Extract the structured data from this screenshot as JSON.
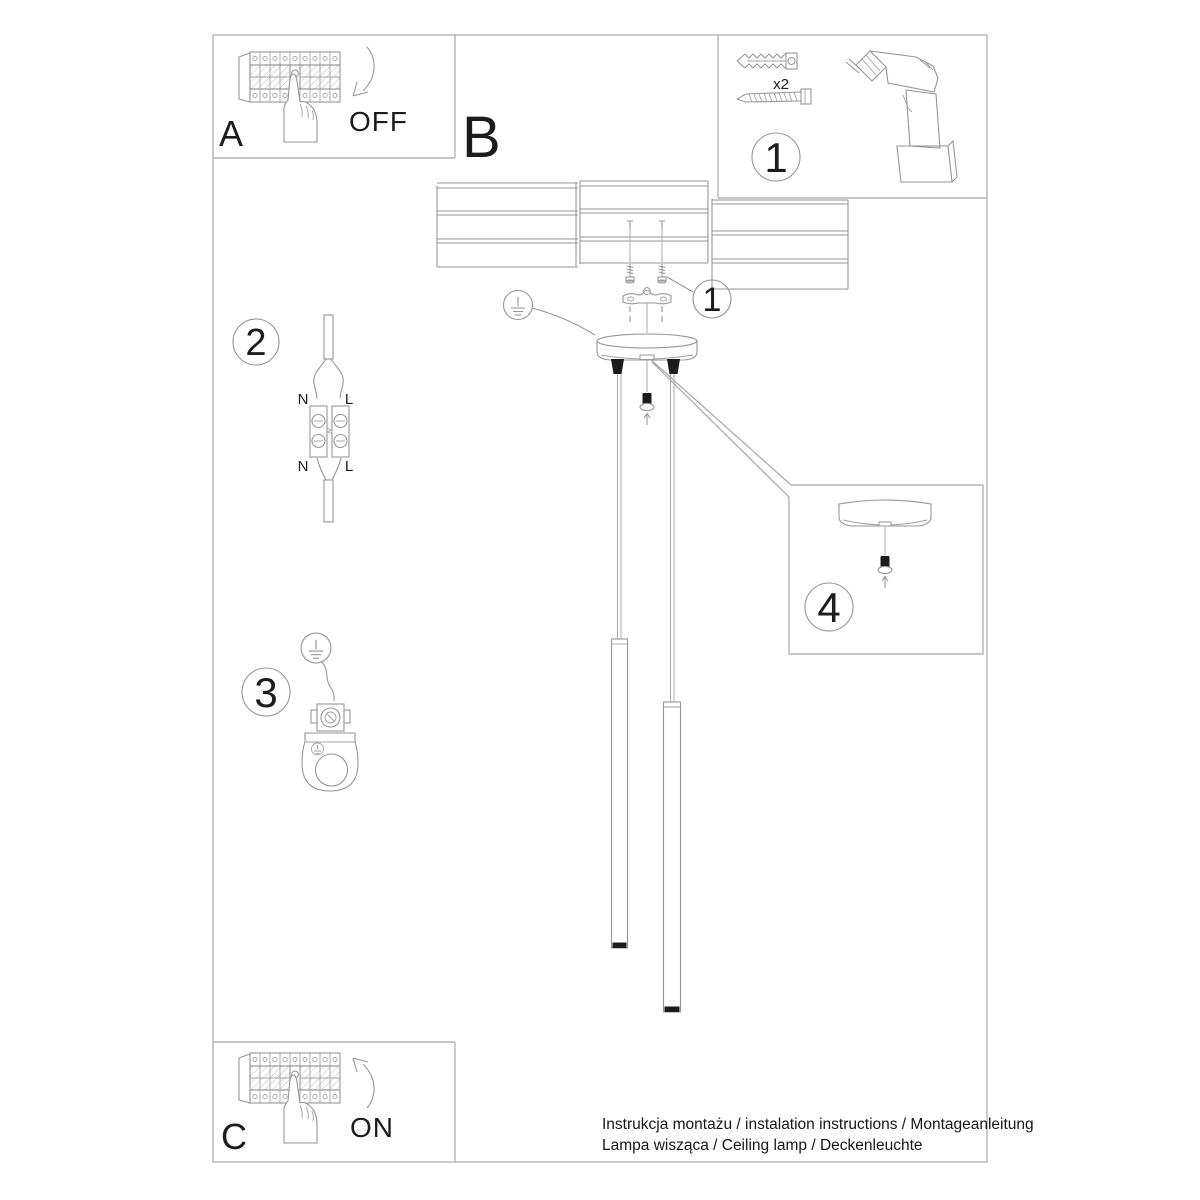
{
  "sheet": {
    "panel_a": {
      "label": "A",
      "state": "OFF"
    },
    "panel_b": {
      "label": "B"
    },
    "panel_c": {
      "label": "C",
      "state": "ON"
    },
    "step1": {
      "number": "1",
      "anchor_qty": "x2"
    },
    "step1_callout": {
      "number": "1"
    },
    "step2": {
      "number": "2",
      "terminals": {
        "n_in": "N",
        "l_in": "L",
        "n_out": "N",
        "l_out": "L"
      }
    },
    "step3": {
      "number": "3"
    },
    "step4": {
      "number": "4"
    },
    "footer": {
      "line1": "Instrukcja montażu / instalation instructions / Montageanleitung",
      "line2": "Lampa wisząca / Ceiling lamp / Deckenleuchte"
    },
    "colors": {
      "line": "#969696",
      "border": "#a8a8a8",
      "ink": "#1c1c1c",
      "background": "#ffffff"
    }
  }
}
